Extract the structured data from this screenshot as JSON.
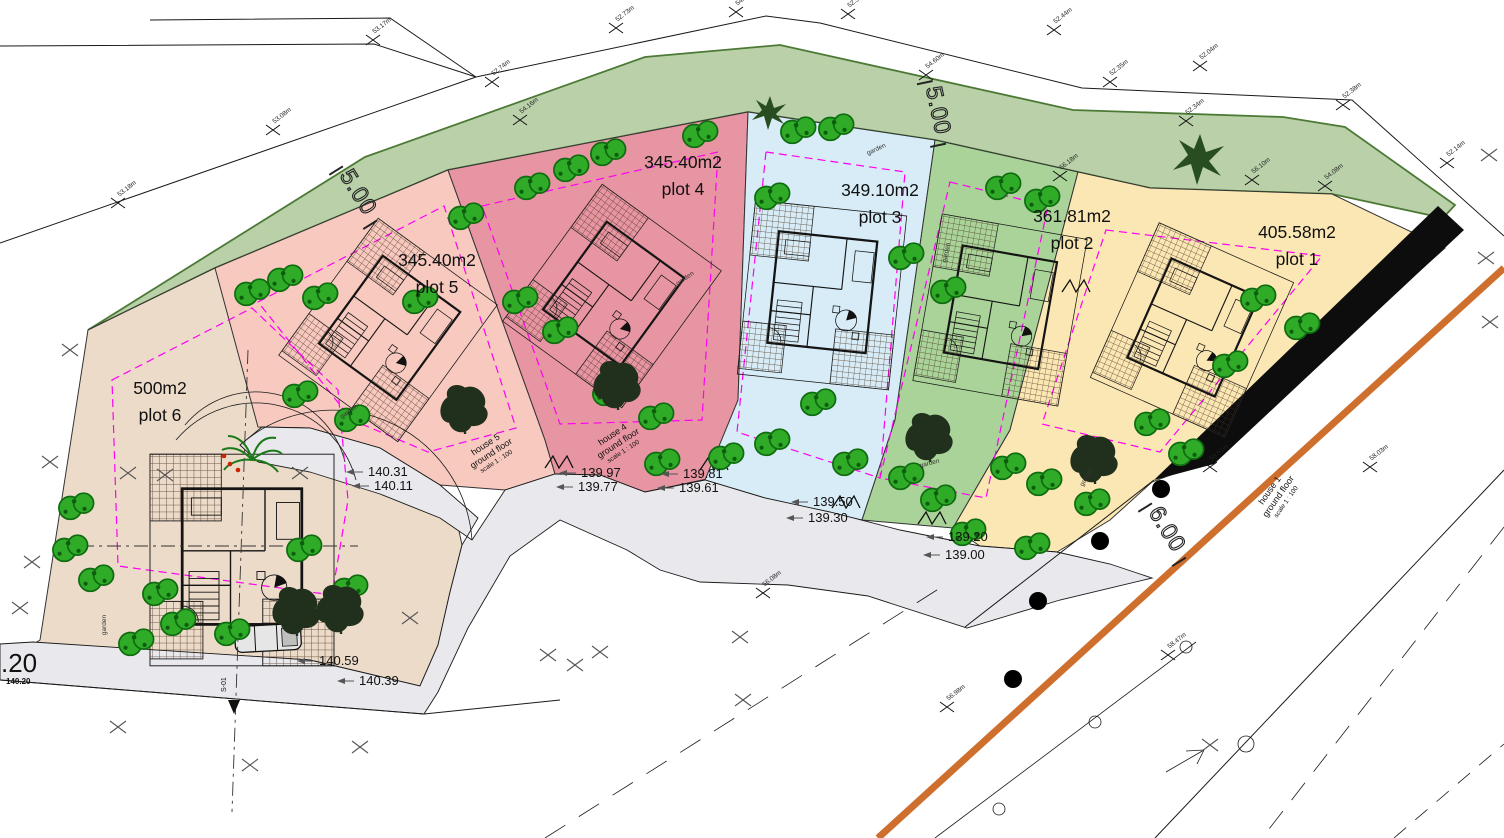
{
  "document": {
    "type": "residential site development plan"
  },
  "plots": [
    {
      "id": "plot-1",
      "area": "405.58m2",
      "label": "plot 1",
      "color": "#fbe7b4",
      "x": 1297,
      "y": 238
    },
    {
      "id": "plot-2",
      "area": "361.81m2",
      "label": "plot 2",
      "color": "#a9d399",
      "x": 1072,
      "y": 222
    },
    {
      "id": "plot-3",
      "area": "349.10m2",
      "label": "plot 3",
      "color": "#d7ecf6",
      "x": 880,
      "y": 196
    },
    {
      "id": "plot-4",
      "area": "345.40m2",
      "label": "plot 4",
      "color": "#e795a2",
      "x": 683,
      "y": 168
    },
    {
      "id": "plot-5",
      "area": "345.40m2",
      "label": "plot 5",
      "color": "#f7c9bf",
      "x": 437,
      "y": 266
    },
    {
      "id": "plot-6",
      "area": "500m2",
      "label": "plot 6",
      "color": "#ecdbc9",
      "x": 160,
      "y": 394
    }
  ],
  "house_labels": [
    {
      "lines": [
        "house 5",
        "ground floor",
        "scale 1 : 100"
      ],
      "x": 487,
      "y": 447,
      "rot": -33
    },
    {
      "lines": [
        "house 4",
        "ground floor",
        "scale 1 : 100"
      ],
      "x": 614,
      "y": 437,
      "rot": -33
    },
    {
      "lines": [
        "house 1",
        "ground floor",
        "scale 1 : 100"
      ],
      "x": 1272,
      "y": 492,
      "rot": -55
    }
  ],
  "road_levels": [
    {
      "t": "140.31",
      "x": 368,
      "y": 476
    },
    {
      "t": "140.11",
      "x": 374,
      "y": 490
    },
    {
      "t": "139.97",
      "x": 581,
      "y": 477
    },
    {
      "t": "139.77",
      "x": 578,
      "y": 491
    },
    {
      "t": "139.81",
      "x": 683,
      "y": 478
    },
    {
      "t": "139.61",
      "x": 679,
      "y": 492
    },
    {
      "t": "139.50",
      "x": 813,
      "y": 506
    },
    {
      "t": "139.30",
      "x": 808,
      "y": 522
    },
    {
      "t": "139.20",
      "x": 948,
      "y": 541
    },
    {
      "t": "139.00",
      "x": 945,
      "y": 559
    },
    {
      "t": "140.59",
      "x": 319,
      "y": 665
    },
    {
      "t": "140.39",
      "x": 359,
      "y": 685
    }
  ],
  "edge_level": {
    "partial": ".20",
    "full": "140.20"
  },
  "dimensions": [
    {
      "t": "5.00",
      "x": 352,
      "y": 196,
      "rot": 58
    },
    {
      "t": "5.00",
      "x": 931,
      "y": 112,
      "rot": 78
    },
    {
      "t": "6.00",
      "x": 1161,
      "y": 533,
      "rot": 58
    }
  ],
  "section_marker": "S-01",
  "garden_text": "garden",
  "garden_labels": [
    {
      "x": 877,
      "y": 151,
      "rot": -25
    },
    {
      "x": 948,
      "y": 253,
      "rot": -78
    },
    {
      "x": 930,
      "y": 465,
      "rot": -15
    },
    {
      "x": 1088,
      "y": 478,
      "rot": -60
    },
    {
      "x": 106,
      "y": 625,
      "rot": -90
    },
    {
      "x": 350,
      "y": 413,
      "rot": -35
    },
    {
      "x": 686,
      "y": 280,
      "rot": -35
    }
  ],
  "survey_marks": [
    {
      "t": "53.17m",
      "x": 373,
      "y": 40
    },
    {
      "t": "53.18m",
      "x": 118,
      "y": 203
    },
    {
      "t": "53.08m",
      "x": 273,
      "y": 130
    },
    {
      "t": "52.74m",
      "x": 492,
      "y": 82
    },
    {
      "t": "52.73m",
      "x": 616,
      "y": 28
    },
    {
      "t": "54.82m",
      "x": 736,
      "y": 12
    },
    {
      "t": "52.50m",
      "x": 848,
      "y": 14
    },
    {
      "t": "54.60m",
      "x": 926,
      "y": 75
    },
    {
      "t": "52.44m",
      "x": 1054,
      "y": 30
    },
    {
      "t": "52.35m",
      "x": 1110,
      "y": 82
    },
    {
      "t": "52.04m",
      "x": 1200,
      "y": 66
    },
    {
      "t": "52.34m",
      "x": 1186,
      "y": 121
    },
    {
      "t": "52.38m",
      "x": 1343,
      "y": 105
    },
    {
      "t": "52.14m",
      "x": 1447,
      "y": 163
    },
    {
      "t": "54.16m",
      "x": 520,
      "y": 120
    },
    {
      "t": "56.18m",
      "x": 1060,
      "y": 176
    },
    {
      "t": "56.10m",
      "x": 1252,
      "y": 180
    },
    {
      "t": "54.08m",
      "x": 1325,
      "y": 186
    },
    {
      "t": "58.51m",
      "x": 1210,
      "y": 467
    },
    {
      "t": "58.03m",
      "x": 1370,
      "y": 467
    },
    {
      "t": "58.47m",
      "x": 1168,
      "y": 655
    },
    {
      "t": "56.98m",
      "x": 947,
      "y": 707
    },
    {
      "t": "56.08m",
      "x": 763,
      "y": 593
    }
  ],
  "colors": {
    "green_buffer": "#b9d0a9",
    "buffer_edge": "#4c7a35",
    "road": "#e9e9ed",
    "orange_line": "#cf6f2d",
    "setback_line": "#ff00f2",
    "tree_green": "#2fab28",
    "tree_dark": "#20301c",
    "boundary_black": "#0d0d0d"
  }
}
